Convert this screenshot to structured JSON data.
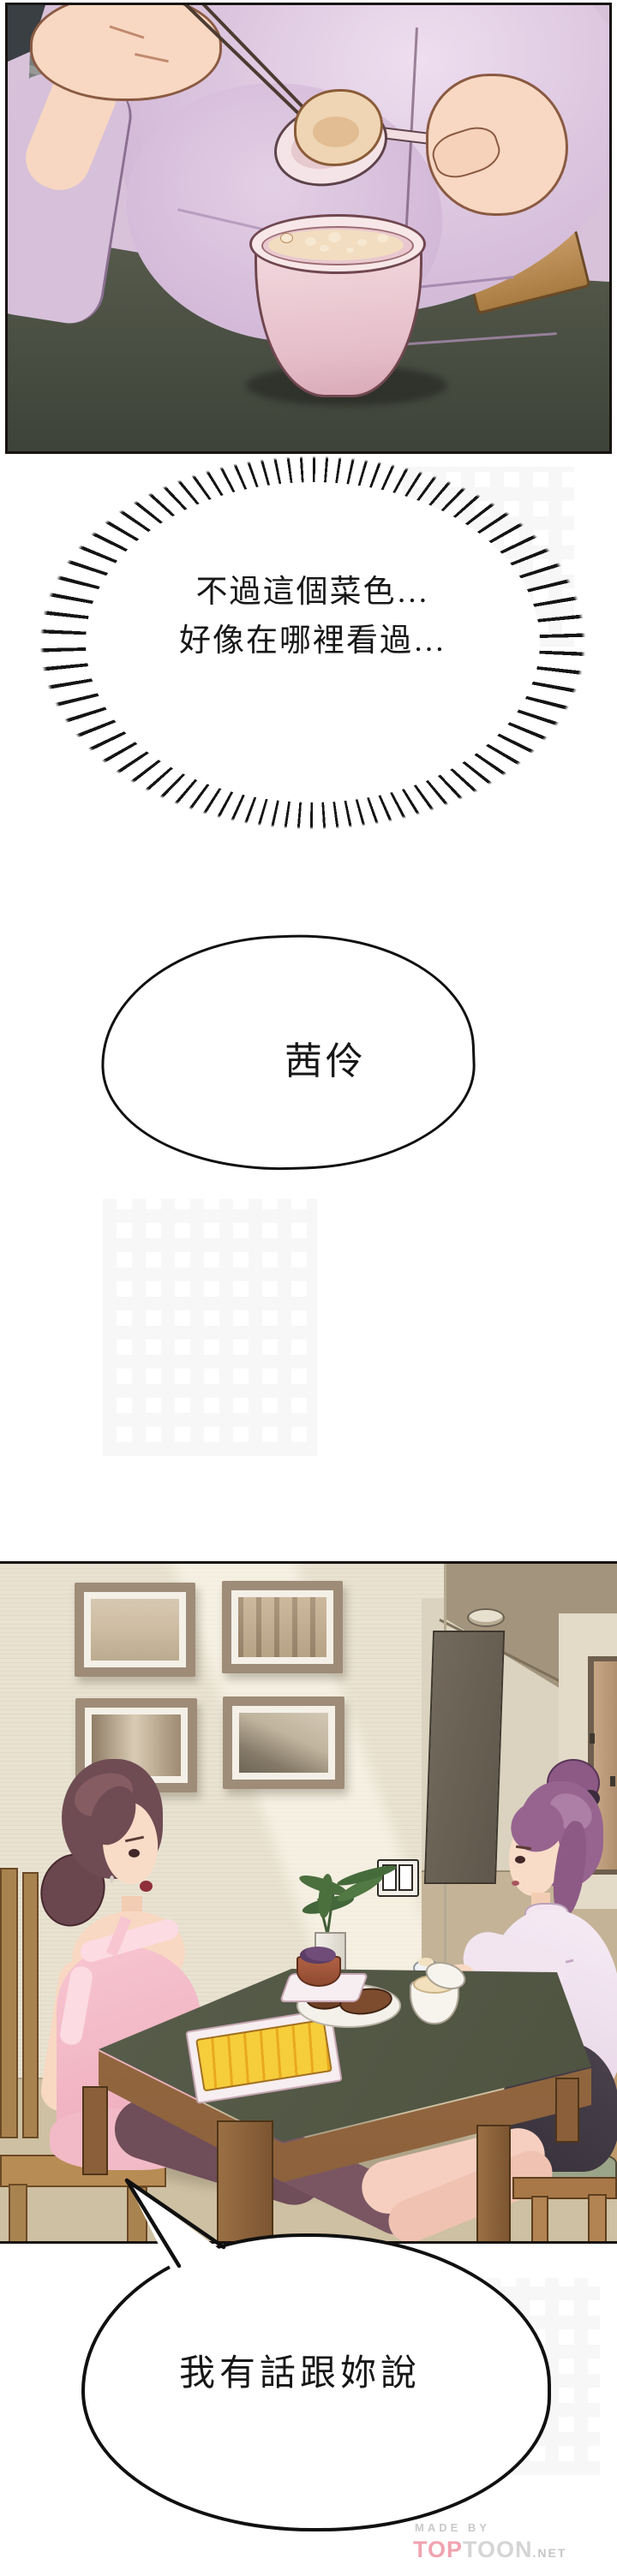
{
  "speech": {
    "burst_line1": "不過這個菜色…",
    "burst_line2": "好像在哪裡看過…",
    "name_bubble": "茜伶",
    "bottom_bubble": "我有話跟妳說"
  },
  "watermark": {
    "made_by": "MADE BY",
    "brand_top": "TOP",
    "brand_toon": "TOON",
    "brand_net": ".NET"
  },
  "colors": {
    "brand_pink": "#f0a3b0",
    "watermark_gray": "#d5d5d5",
    "panel_border": "#17130f",
    "table_green": "#555a45",
    "shirt_lavender": "#d8c2da",
    "apron_pink": "#f4bcc8"
  }
}
